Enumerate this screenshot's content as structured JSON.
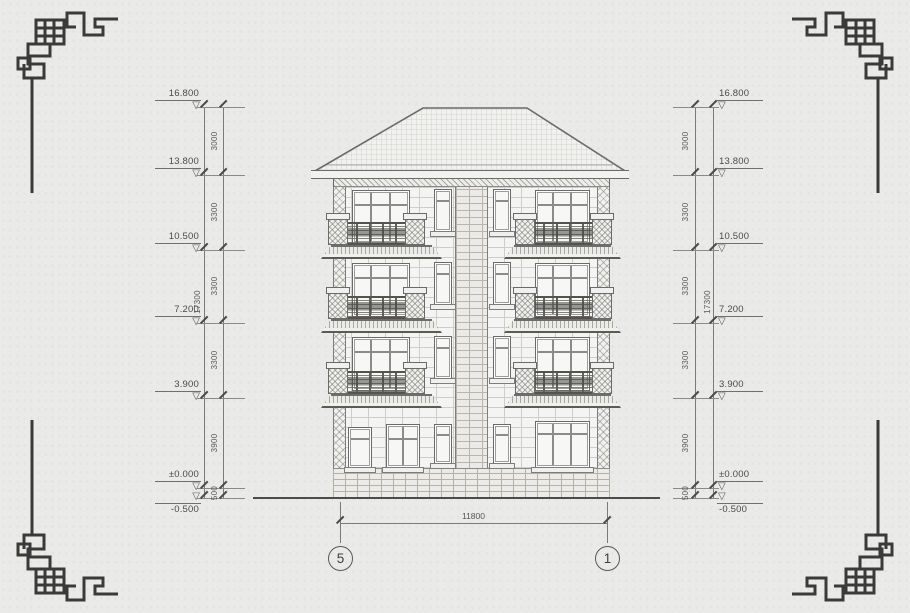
{
  "palette": {
    "paper": "#eaeae8",
    "drawing_line": "#6a6a68",
    "dark_line": "#4a4a48",
    "ornament": "#3a3a3a",
    "text": "#4a4a48"
  },
  "elevation_marks": [
    {
      "label": "16.800"
    },
    {
      "label": "13.800"
    },
    {
      "label": "10.500"
    },
    {
      "label": "7.200"
    },
    {
      "label": "3.900"
    },
    {
      "label": "±0.000"
    },
    {
      "label": "-0.500"
    }
  ],
  "height_segments": [
    {
      "value": "3000"
    },
    {
      "value": "3300"
    },
    {
      "value": "3300"
    },
    {
      "value": "3300"
    },
    {
      "value": "3900"
    },
    {
      "value": "500"
    }
  ],
  "total_height": "17300",
  "bottom_dimension": {
    "width": "11800",
    "axis_left": "5",
    "axis_right": "1"
  },
  "icons": {
    "level_marker_glyph": "▽"
  }
}
